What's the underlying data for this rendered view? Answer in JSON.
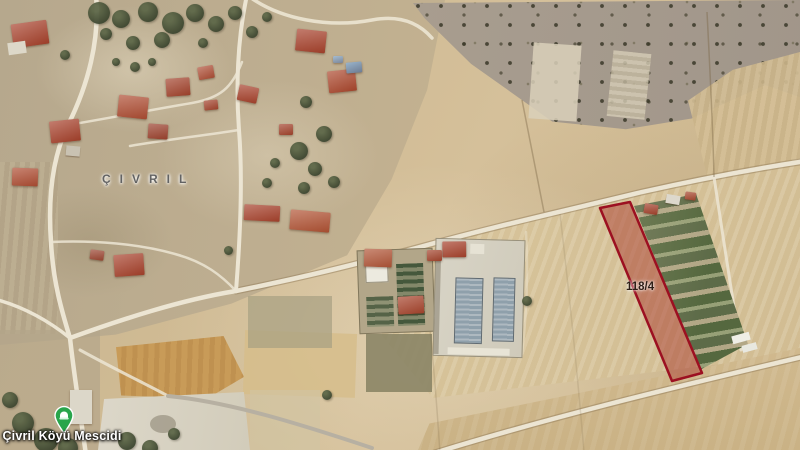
{
  "map": {
    "type": "satellite-map",
    "place_watermark": "ÇIVRIL",
    "parcel": {
      "label": "118/4"
    },
    "poi": {
      "label": "Çivril Köyü Mescidi",
      "icon": "mosque-pin-icon"
    },
    "colors": {
      "parcel_stroke": "#9c1021",
      "parcel_fill": "rgba(170,60,48,0.5)",
      "parcel_label": "#2e1f17",
      "pin_green": "#28a54b",
      "poi_label": "#ffffff",
      "watermark": "#636363",
      "road": "#ece5d3",
      "roof_red": "#a8432e",
      "tree_green": "#47503a",
      "field_tan": "#cfba93",
      "scrub_gray": "#a69b8d",
      "warehouse_gray": "#93a0a8"
    }
  }
}
